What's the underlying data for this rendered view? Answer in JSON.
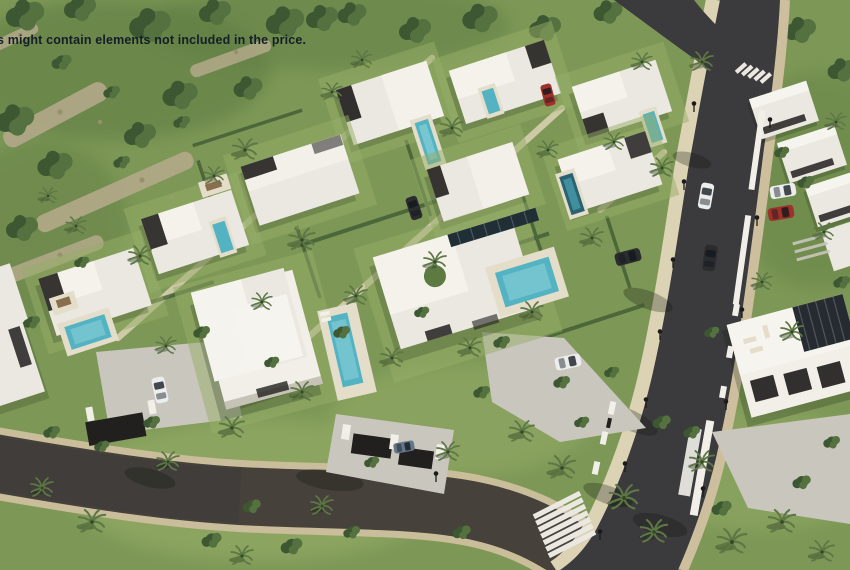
{
  "window": {
    "width": 850,
    "height": 570
  },
  "overlay": {
    "disclaimer_text": "s might contain elements not included in the price."
  },
  "scene": {
    "description": "Aerial 3D render of a luxury villa development: white flat-roofed villas with turquoise pools and landscaped gardens on a green hillside, a curving main asphalt road with zebra crosswalks, street lamps, parked cars and palm trees",
    "colors": {
      "disclaimer": "#141e29",
      "grass": "#7d9856",
      "grassL": "#95ad68",
      "grassD": "#5d7a42",
      "tree": "#3c5731",
      "treeM": "#54713f",
      "palm": "#5d7746",
      "rock": "#b3a98a",
      "rockD": "#97906f",
      "road": "#3b3a3c",
      "roadW": "#46413a",
      "curb": "#cdbf9e",
      "walk": "#dcd2b4",
      "roof": "#eae8e0",
      "roofL": "#f6f4ee",
      "wall": "#f1efe8",
      "wallS": "#c6c2b6",
      "dark": "#21201e",
      "pool": "#54b3c3",
      "poolL": "#9adade",
      "poolD": "#2a6272",
      "deck": "#e4ddca",
      "conc": "#c9c6bd",
      "stripe": "#eae8e0",
      "carR": "#a03029",
      "carD": "#2b2c2e",
      "carW": "#eceded",
      "carB": "#647787",
      "lamp": "#1b1b1b"
    }
  }
}
